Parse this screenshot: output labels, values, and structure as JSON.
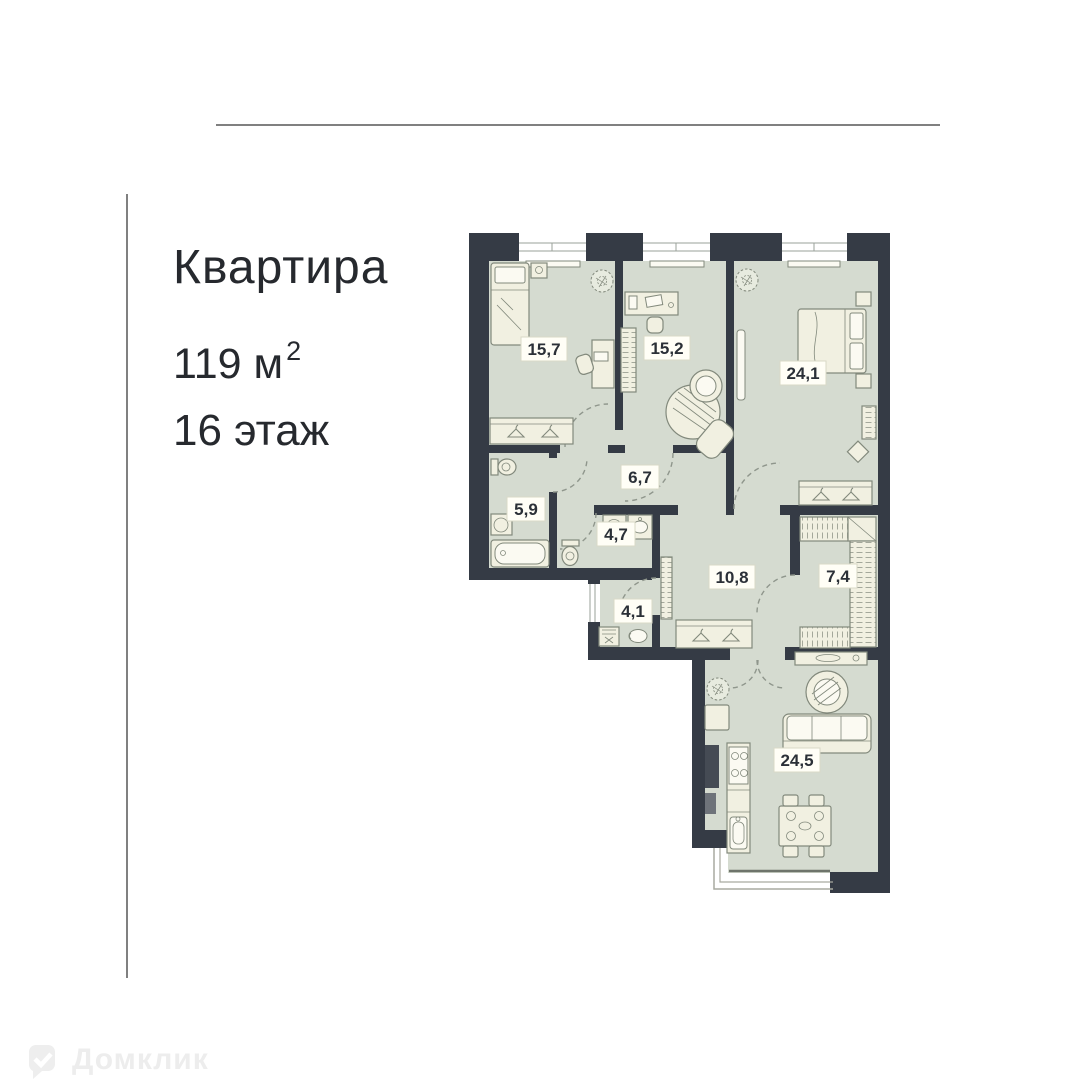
{
  "header": {
    "title": "Квартира",
    "area_number": "119",
    "area_unit": "м",
    "area_superscript": "2",
    "floor_label": "16 этаж"
  },
  "floor_plan": {
    "rooms": [
      {
        "id": "bedroom-1",
        "area": "15,7"
      },
      {
        "id": "bedroom-2",
        "area": "15,2"
      },
      {
        "id": "bedroom-3",
        "area": "24,1"
      },
      {
        "id": "hallway",
        "area": "6,7"
      },
      {
        "id": "bathroom-1",
        "area": "5,9"
      },
      {
        "id": "bathroom-2",
        "area": "4,7"
      },
      {
        "id": "corridor",
        "area": "10,8"
      },
      {
        "id": "wardrobe-room",
        "area": "7,4"
      },
      {
        "id": "laundry",
        "area": "4,1"
      },
      {
        "id": "living-kitchen",
        "area": "24,5"
      }
    ],
    "colors": {
      "walls": "#353b45",
      "floor": "#d5dbd0",
      "furniture": "#f1f0e1",
      "label_background": "#fffef6"
    }
  },
  "watermark": {
    "brand": "Домклик"
  }
}
